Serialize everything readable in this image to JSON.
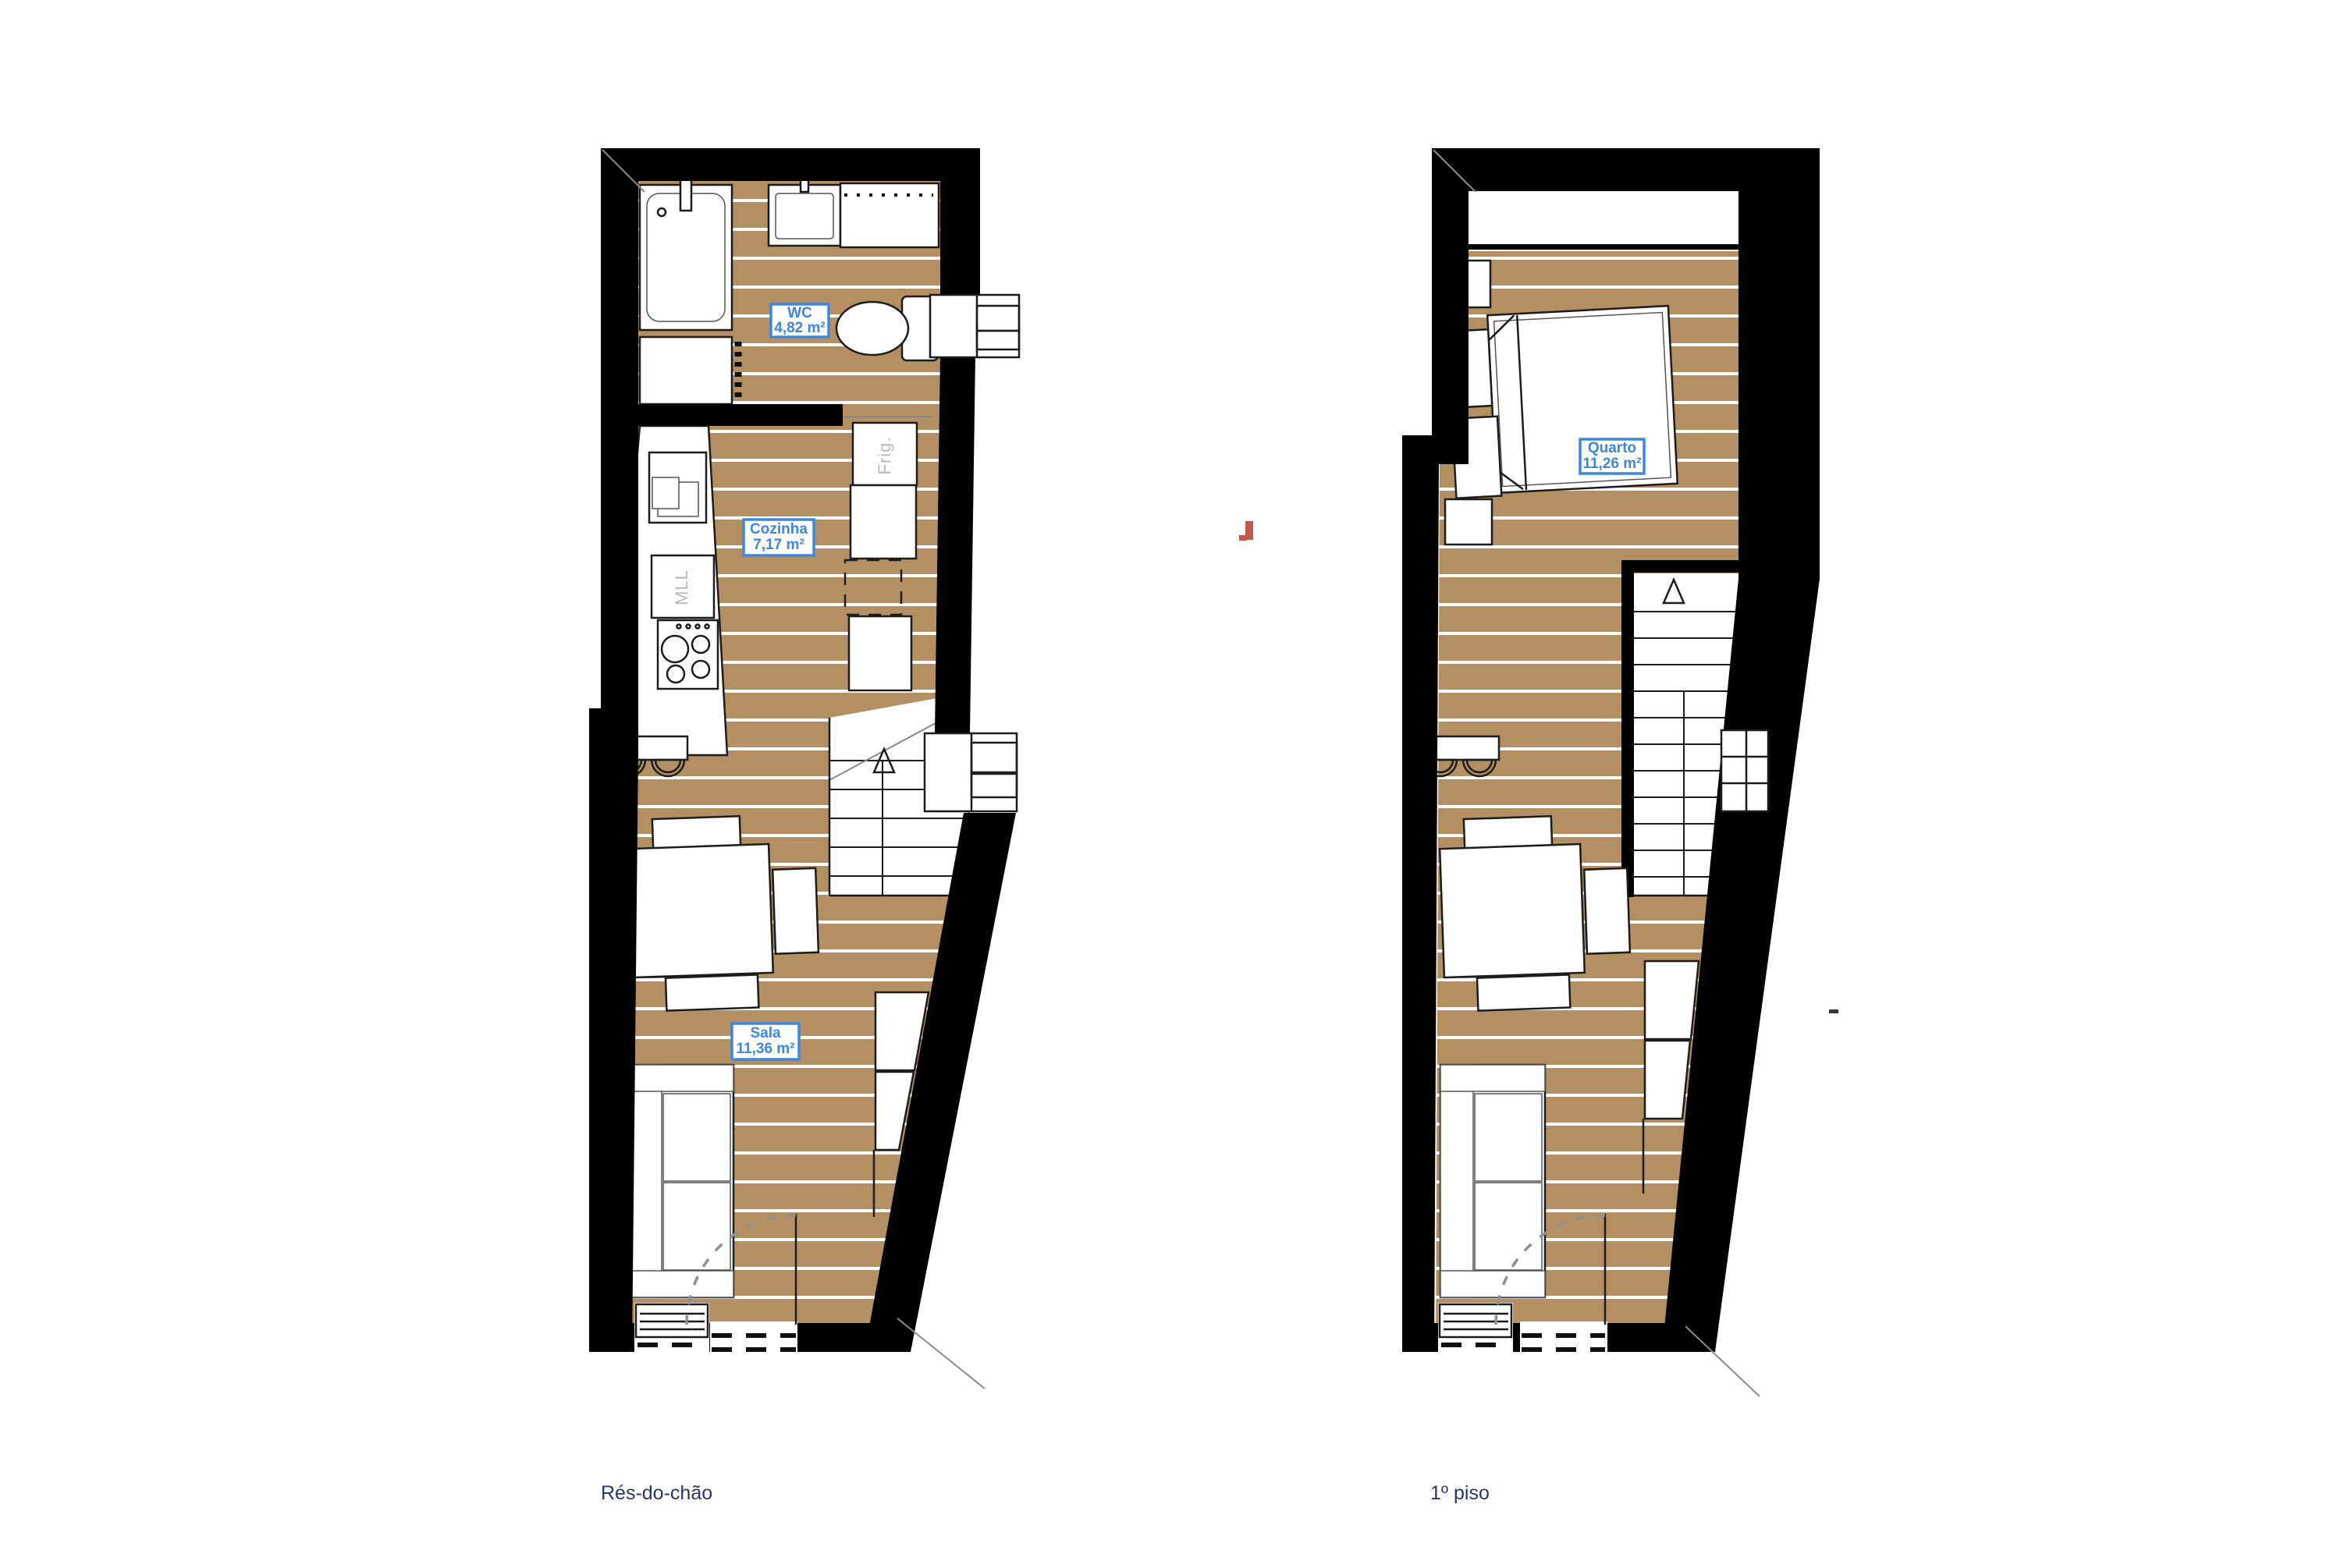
{
  "plans": {
    "ground": {
      "caption": "Rés-do-chão",
      "rooms": [
        {
          "name": "WC",
          "area": "4,82 m²"
        },
        {
          "name": "Cozinha",
          "area": "7,17 m²"
        },
        {
          "name": "Sala",
          "area": "11,36 m²"
        }
      ],
      "appliances": [
        {
          "label": "Frig."
        },
        {
          "label": "MLL"
        }
      ]
    },
    "first": {
      "caption": "1º piso",
      "rooms": [
        {
          "name": "Quarto",
          "area": "11,26 m²"
        }
      ]
    }
  },
  "colors": {
    "wall": "#000000",
    "floor": "#b48f61",
    "plank_line": "#ffffff",
    "accent": "#3d87dd",
    "caption": "#26366b",
    "appliance": "#b9b9b9",
    "red": "#c4564a"
  }
}
